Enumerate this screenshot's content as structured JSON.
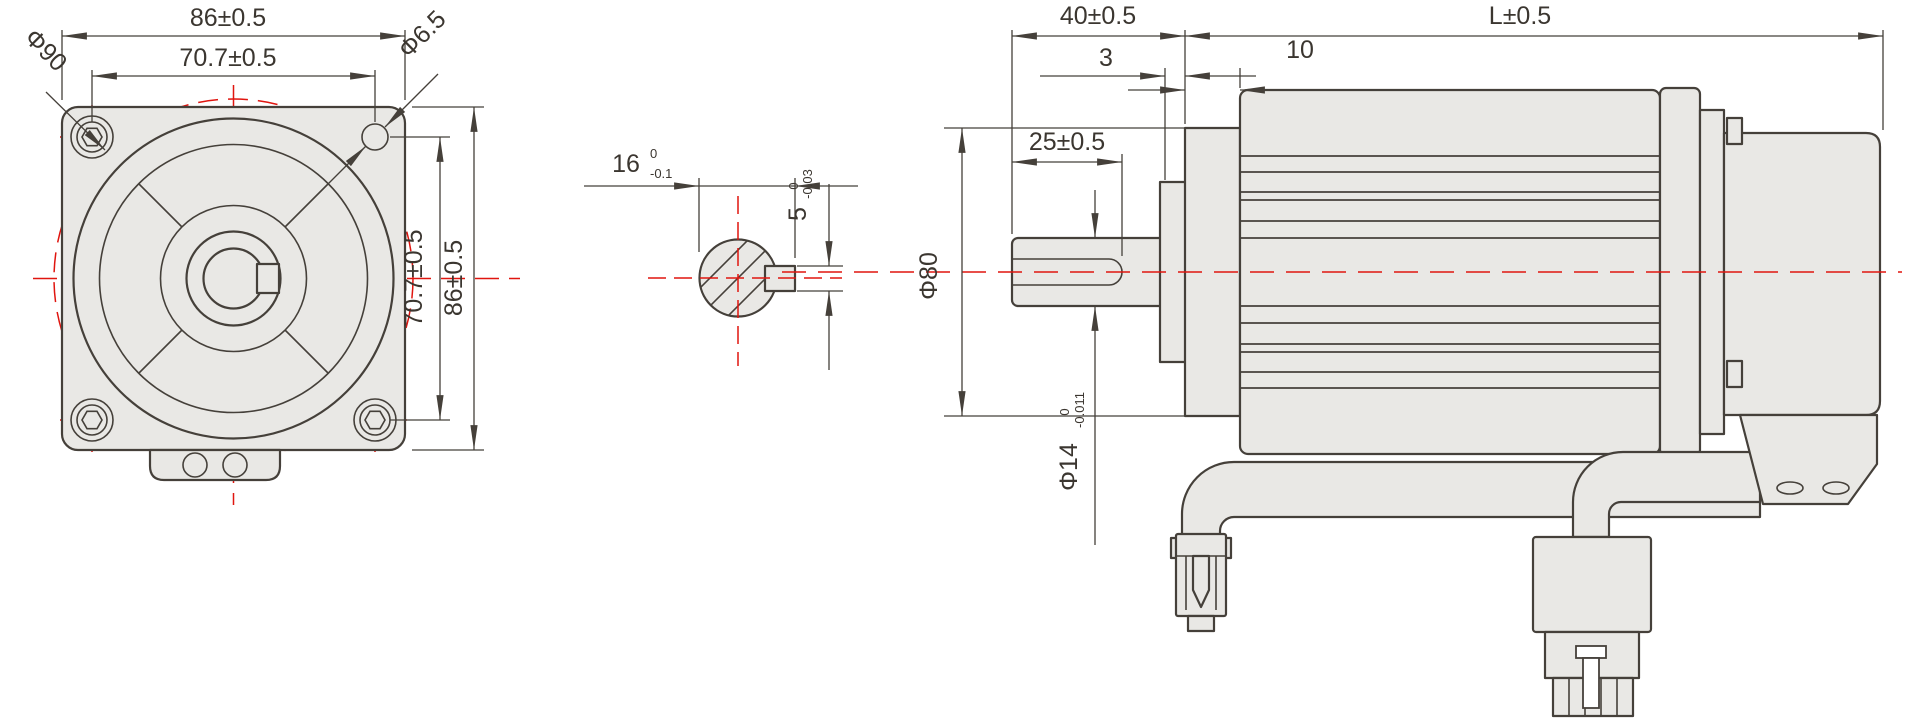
{
  "front_view": {
    "dim_width": "86±0.5",
    "dim_hole_spacing_h": "70.7±0.5",
    "dim_pilot_circle": "Φ90",
    "dim_hole_dia": "Φ6.5",
    "dim_hole_spacing_v": "70.7±0.5",
    "dim_height": "86±0.5"
  },
  "shaft_section": {
    "dim_flat": {
      "value": "16",
      "tol_upper": "0",
      "tol_lower": "-0.1"
    },
    "dim_key_width": {
      "value": "5",
      "tol_upper": "0",
      "tol_lower": "-0.03"
    }
  },
  "side_view": {
    "dim_shaft_length": "40±0.5",
    "dim_body_length": "L±0.5",
    "dim_boss": "3",
    "dim_flange_offset": "10",
    "dim_keyway_length": "25±0.5",
    "dim_flange_dia": "Φ80",
    "dim_shaft_dia": {
      "value": "Φ14",
      "tol_upper": "0",
      "tol_lower": "-0.011"
    }
  },
  "colors": {
    "line": "#45403a",
    "fill": "#e9e8e5",
    "centerline_red": "#e0150f",
    "background": "#ffffff"
  }
}
